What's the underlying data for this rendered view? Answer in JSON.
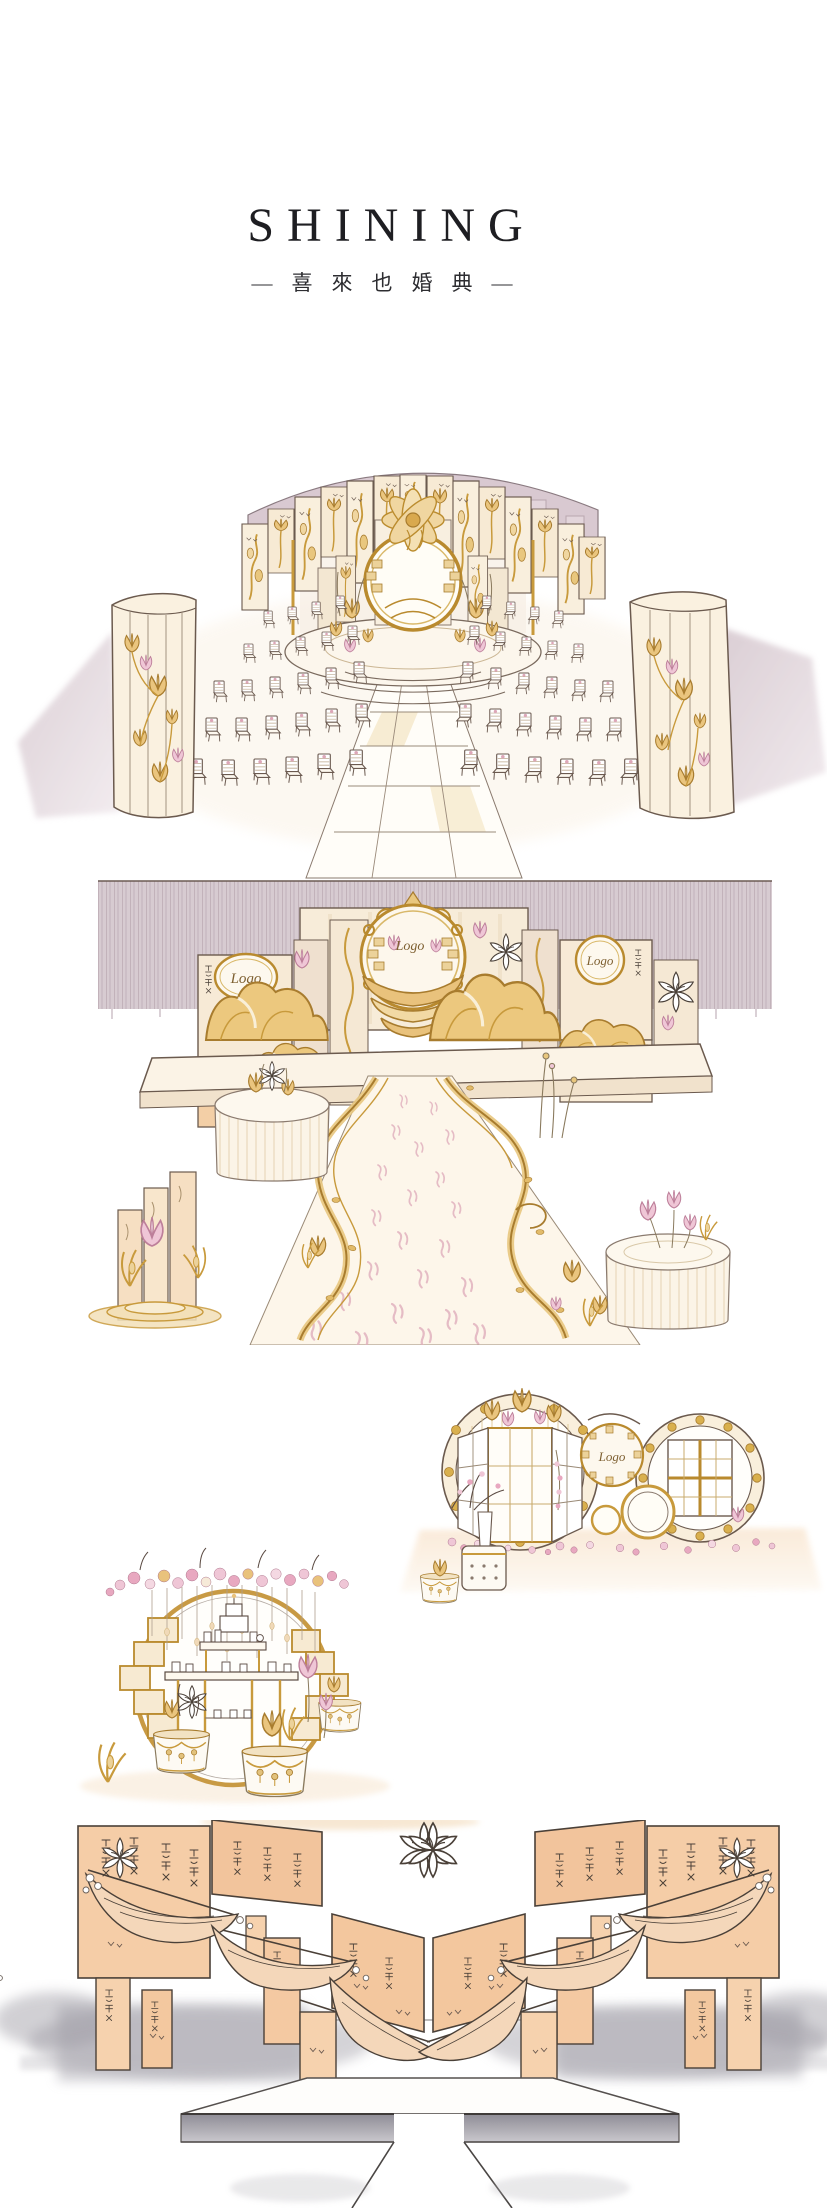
{
  "page": {
    "background_color": "#ffffff"
  },
  "header": {
    "title": "SHINING",
    "subtitle": "—喜來也婚典—"
  },
  "artwork": {
    "logo_placeholder_text": "Logo"
  },
  "palette": {
    "ink": "#6b5a4e",
    "cream": "#f8efdf",
    "gold": "#c89a3c",
    "gold_deep": "#a87c2e",
    "mauve": "#d9c9d1",
    "peach": "#f5cda7",
    "pink": "#e8bccd",
    "shadow_gray": "#a9a7b0"
  }
}
